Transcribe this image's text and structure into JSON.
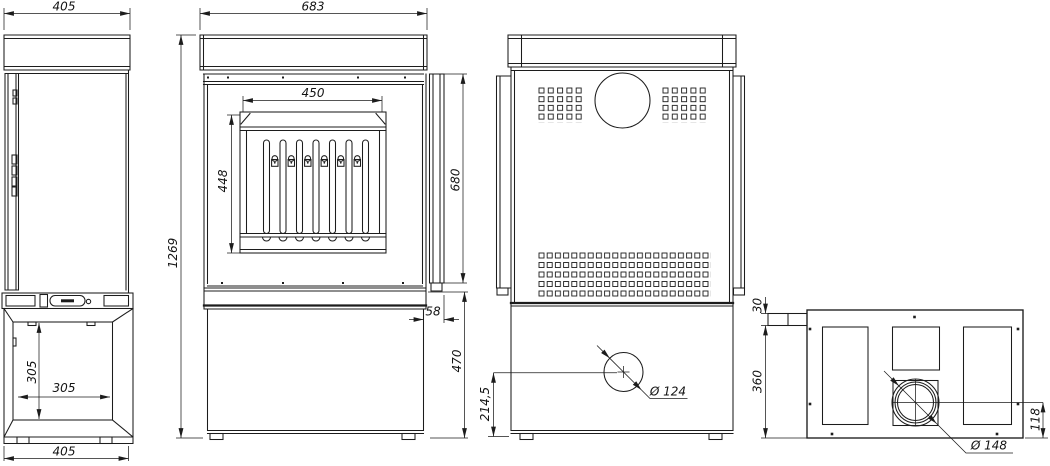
{
  "colors": {
    "line": "#1c1c1c",
    "background": "#ffffff"
  },
  "views": {
    "side": {
      "dims": {
        "top_width": "405",
        "opening_height": "305",
        "opening_width": "305",
        "bottom_width": "405"
      }
    },
    "front": {
      "dims": {
        "width": "683",
        "glass_width": "450",
        "glass_height": "448",
        "total_height": "1269",
        "shield_height": "680",
        "shield_offset": "58",
        "base_height": "470"
      }
    },
    "back": {
      "dims": {
        "flue_center_height": "214,5",
        "flue_diameter": "Ø 124"
      }
    },
    "top": {
      "dims": {
        "handle_depth": "30",
        "body_depth": "360",
        "flue_offset": "118",
        "flue_diameter": "Ø 148"
      }
    }
  }
}
